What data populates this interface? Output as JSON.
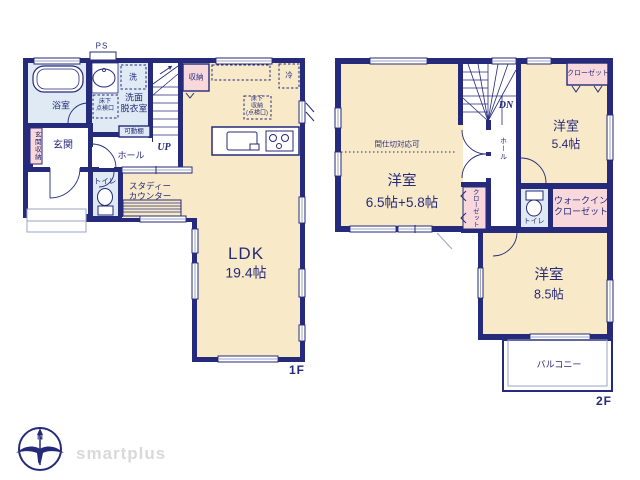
{
  "colors": {
    "wall": "#252a7a",
    "room_beige": "#f8e9c8",
    "wet_blue": "#dfeaf4",
    "closet_pink": "#f8d8da",
    "window_line": "#9aa6c4",
    "brand_gray": "#d9d9d9"
  },
  "floor1": {
    "label": "1F",
    "rooms": {
      "ps": "PS",
      "bathroom": "浴室",
      "laundry": "洗",
      "washroom": [
        "洗面",
        "脱衣室"
      ],
      "inspection_hatch": [
        "床下",
        "点検口"
      ],
      "movable_shelf": "可動棚",
      "entrance_storage": "玄関収納",
      "entrance": "玄関",
      "hall": "ホール",
      "stairs_up": "UP",
      "storage": "収納",
      "fridge": "冷",
      "underfloor_storage": [
        "床下",
        "収納",
        "(点検口)"
      ],
      "toilet": "トイレ",
      "study_counter": [
        "スタディー",
        "カウンター"
      ],
      "ldk_name": "LDK",
      "ldk_size": "19.4帖"
    }
  },
  "floor2": {
    "label": "2F",
    "rooms": {
      "partition_note": "間仕切対応可",
      "stairs_down": "DN",
      "hall": "ホール",
      "bedroom_main_name": "洋室",
      "bedroom_main_size": "6.5帖+5.8帖",
      "bedroom_small_name": "洋室",
      "bedroom_small_size": "5.4帖",
      "bedroom_south_name": "洋室",
      "bedroom_south_size": "8.5帖",
      "closet_small": "クローゼット",
      "closet_mid": "クローゼット",
      "toilet": "トイレ",
      "walk_in_closet": [
        "ウォークイン",
        "クローゼット"
      ],
      "balcony": "バルコニー"
    }
  },
  "logo": {
    "compass_north": "N",
    "brand": "smartplus"
  }
}
